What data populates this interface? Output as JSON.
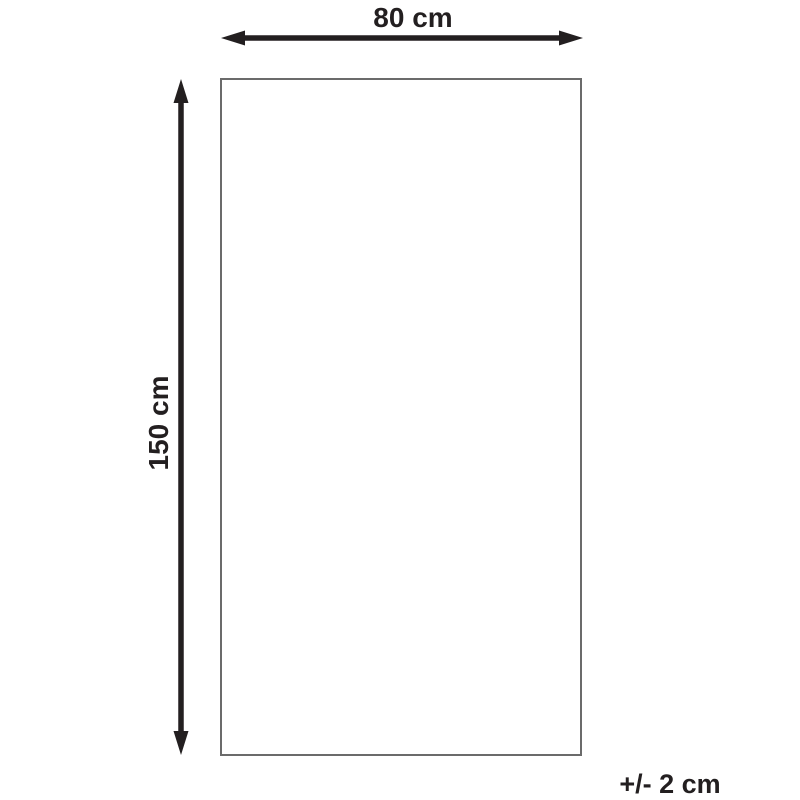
{
  "diagram": {
    "type": "product-dimension-diagram",
    "width_label": "80 cm",
    "height_label": "150 cm",
    "tolerance_label": "+/- 2 cm"
  },
  "icons": {
    "horizontal_arrow": "double-headed-horizontal-arrow",
    "vertical_arrow": "double-headed-vertical-arrow"
  },
  "colors": {
    "arrow": "#231f20",
    "outline": "#6b6b6b",
    "background": "#ffffff"
  }
}
